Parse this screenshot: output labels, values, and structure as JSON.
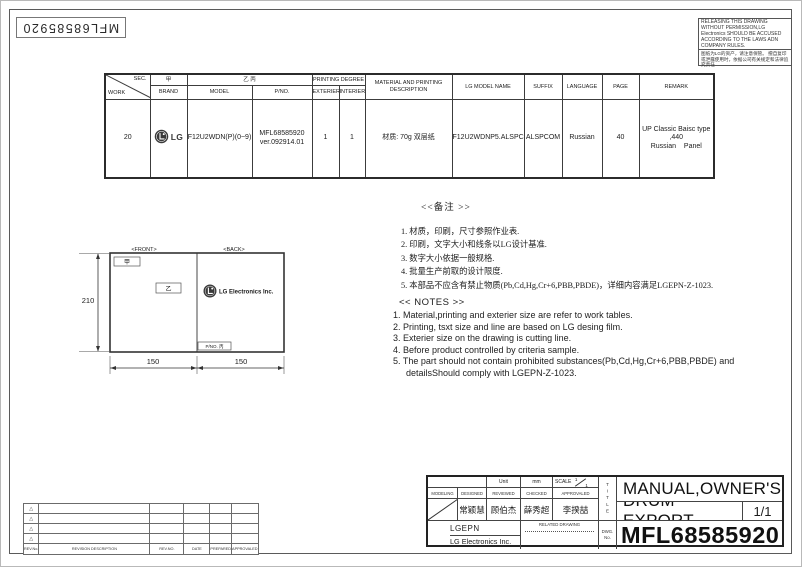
{
  "sheet": {
    "stamp_text": "MFL68585920",
    "notice_en": "RELEASING THIS DRAWING WITHOUT PERMISSION,LG Electronics SHOULD BE ACCUSED ACCORDING TO THE LAWS ADN COMPANY RULES.",
    "notice_cn": "图纸为LG的资产，请注意保管。 擅自复印或泄露使用时，依据公司有关规定和法律追究责任"
  },
  "spec_table": {
    "diagonal": {
      "top": "SEC.",
      "bottom": "WORK"
    },
    "headers": {
      "brand_cn": "甲",
      "brand": "BRAND",
      "model_cn": "乙 丙",
      "model": "MODEL",
      "pno": "P/NO.",
      "printing_degree": "PRINTING DEGREE",
      "exterier": "EXTERIER",
      "interier": "INTERIER",
      "material": "MATERIAL AND PRINTING DESCRIPTION",
      "lg_model_name": "LG MODEL NAME",
      "suffix": "SUFFIX",
      "language": "LANGUAGE",
      "page": "PAGE",
      "remark": "REMARK"
    },
    "row": {
      "work": "20",
      "brand_logo": "LG",
      "model": "F12U2WDN(P)(0~9)",
      "pno_line1": "MFL68585920",
      "pno_line2": "ver.092914.01",
      "exterier": "1",
      "interier": "1",
      "material": "材质: 70g 双层纸",
      "lg_model_name": "F12U2WDNP5.ALSPCOM",
      "suffix": "ALSPCOM",
      "language": "Russian",
      "page": "40",
      "remark_line1": "UP Classic Baisc type ,440",
      "remark_line2": "Russian Panel"
    }
  },
  "drawing": {
    "front_label": "<FRONT>",
    "back_label": "<BACK>",
    "front_box1": "甲",
    "front_box2": "乙",
    "back_logo_text": "LG Electronics Inc.",
    "back_pno_box": "P/NO. 丙",
    "dim_height": "210",
    "dim_width_left": "150",
    "dim_width_right": "150"
  },
  "notes_cn": {
    "title": "<<备注 >>",
    "items": [
      "1.  材质，印刷，尺寸参照作业表.",
      "2.  印刷，文字大小和线条以LG设计基准.",
      "3.  数字大小依据一般规格.",
      "4.  批量生产前取的设计限度.",
      "5.  本部品不应含有禁止物质(Pb,Cd,Hg,Cr+6,PBB,PBDE)，详细内容满足LGEPN-Z-1023."
    ]
  },
  "notes_en": {
    "title": "<< NOTES >>",
    "items": [
      "1. Material,printing and exterier size are refer to work tables.",
      "2. Printing, tsxt  size and line are based on LG desing film.",
      "3. Exterier size on the drawing is cutting line.",
      "4. Before product controlled by criteria sample.",
      "5. The part should not contain prohibited substances(Pb,Cd,Hg,Cr+6,PBB,PBDE) and detailsShould comply with LGEPN-Z-1023."
    ]
  },
  "revision_table": {
    "markers": [
      "△",
      "△",
      "△",
      "△"
    ],
    "headers": [
      "REV.No.",
      "REVISION DESCRIPTION",
      "REV.NO.",
      "DATE",
      "PREPARED",
      "APPROVALED"
    ]
  },
  "title_block": {
    "unit_label": "Unit",
    "unit_value": "mm",
    "scale_label": "SCALE",
    "scale_num": "1",
    "scale_den": "1",
    "col_labels": [
      "MODELING",
      "DESIGNED",
      "REVIEWED",
      "CHECKED",
      "APPROVALED"
    ],
    "names": [
      "常颖慧",
      "顾伯杰",
      "薛秀超",
      "李揆喆"
    ],
    "company_line1": "LGEPN",
    "company_line2": "LG Electronics Inc.",
    "related_drawing": "RELATED DRAWING",
    "title_vertical": "TITLE",
    "dwg_label1": "DWG.",
    "dwg_label2": "No.",
    "title_line1": "MANUAL,OWNER'S",
    "title_line2": "DRUM-EXPORT",
    "sheet_no": "1/1",
    "dwg_no": "MFL68585920"
  }
}
